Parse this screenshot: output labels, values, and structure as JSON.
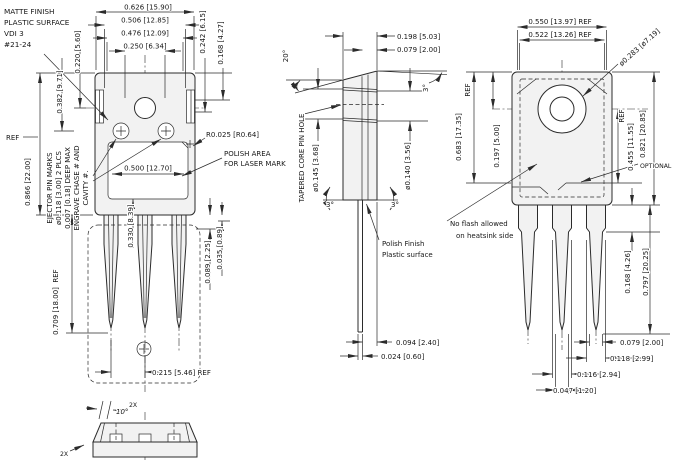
{
  "colors": {
    "ink": "#2b2b2b",
    "paper": "#ffffff",
    "body_fill": "#f2f2f2"
  },
  "labels": {
    "ref": "REF",
    "x2": "2X"
  },
  "front": {
    "note_matte": [
      "MATTE FINISH",
      "PLASTIC SURFACE",
      "VDI 3",
      "#21-24"
    ],
    "note_ejector": [
      "EJECTOR PIN MARKS",
      "ø0.118 [3.00] 2 PLCS",
      "0.007 [0.18] DEEP MAX",
      "ENGRAVE CHASE # AND",
      "CAVITY #."
    ],
    "note_polish": [
      "POLISH AREA",
      "FOR LASER MARK"
    ],
    "dims": {
      "width_overall": "0.626 [15.90]",
      "width_step": "0.506 [12.85]",
      "width_inner": "0.476 [12.09]",
      "hole_span": "0.250 [6.34]",
      "top_to_hole": "0.220 [5.60]",
      "top_to_pins": "0.382 [9.71]",
      "body_height": "0.866 [22.00]",
      "corner_radius": "R0.025 [R0.64]",
      "recess_width": "0.500 [12.70]",
      "recess_depth": "0.330 [8.39]",
      "right_upper": "0.242 [6.15]",
      "right_lower": "0.168 [4.27]",
      "shoulder": "0.089 [2.25]",
      "step": "0.035 [0.89]",
      "lead_length": "0.709 [18.00]",
      "lead_pitch": "0.215 [5.46] REF"
    }
  },
  "bottom": {
    "angle": "10°"
  },
  "side": {
    "note_taper": "TAPERED CORE PIN HOLE",
    "note_polish": [
      "Polish Finish",
      "Plastic surface"
    ],
    "dims": {
      "thickness": "0.198 [5.03]",
      "lead_offset": "0.079 [2.00]",
      "top_angle": "20°",
      "draft": "3°",
      "hole_top": "ø0.145 [3.68]",
      "hole_bottom": "ø0.140 [3.56]",
      "lead_gap": "0.094 [2.40]",
      "lead_thickness": "0.024 [0.60]"
    }
  },
  "back": {
    "note_flash": [
      "No flash allowed",
      "on heatsink side"
    ],
    "optional": "OPTIONAL",
    "dims": {
      "width_top": "0.550 [13.97] REF",
      "width_inner": "0.522 [13.26] REF",
      "boss_dia": "ø0.283 [ø7.19]",
      "left_height": "0.683 [17.35]",
      "hole_to_top": "0.197 [5.00]",
      "right_height": "0.455 [11.55]",
      "total_height": "0.821 [20.85]",
      "shoulder_len": "0.168 [4.26]",
      "lead_len": "0.797 [20.25]",
      "lead_width_narrow": "0.079 [2.00]",
      "lead_width_3": "0.118 [2.99]",
      "lead_width_2": "0.116 [2.94]",
      "lead_tip": "0.047 [1.20]"
    }
  }
}
